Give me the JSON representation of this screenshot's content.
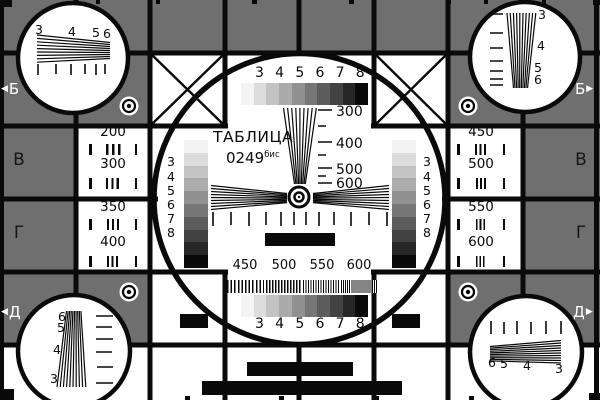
{
  "colors": {
    "cell_gray": "#6f6f6f",
    "line_black": "#0a0a0a",
    "white": "#ffffff"
  },
  "grayscale_steps": [
    "#f4f4f4",
    "#dcdcdc",
    "#c3c3c3",
    "#ababab",
    "#919191",
    "#777777",
    "#5d5d5d",
    "#424242",
    "#262626",
    "#0a0a0a"
  ],
  "title": {
    "name": "ТАБЛИЦА",
    "number": "0249",
    "suffix": "бис"
  },
  "center": {
    "top_digits": "3 4 5 6 7 8",
    "bottom_digits": "3 4 5 6 7 8",
    "wedge_labels": [
      "300",
      "400",
      "500",
      "600"
    ],
    "burst_labels": [
      "450",
      "500",
      "550",
      "600"
    ],
    "left_ramp_digits": [
      "3",
      "4",
      "5",
      "6",
      "7",
      "8"
    ],
    "right_ramp_digits": [
      "3",
      "4",
      "5",
      "6",
      "7",
      "8"
    ]
  },
  "cells": {
    "left": [
      {
        "value": "200"
      },
      {
        "value": "300"
      },
      {
        "value": "350"
      },
      {
        "value": "400"
      }
    ],
    "right": [
      {
        "value": "450"
      },
      {
        "value": "500"
      },
      {
        "value": "550"
      },
      {
        "value": "600"
      }
    ]
  },
  "corners": {
    "top_left_digits": [
      "3",
      "4",
      "5",
      "6"
    ],
    "top_right_digits": [
      "3",
      "4",
      "5",
      "6"
    ],
    "bottom_left_digits": [
      "6",
      "5",
      "4",
      "3"
    ],
    "bottom_right_digits": [
      "6",
      "5",
      "4",
      "3"
    ]
  },
  "edges": {
    "left_arrow": "◀",
    "right_arrow": "▶",
    "rows": [
      {
        "label": "Б"
      },
      {
        "label": "В"
      },
      {
        "label": "Г"
      },
      {
        "label": "Д"
      }
    ]
  }
}
